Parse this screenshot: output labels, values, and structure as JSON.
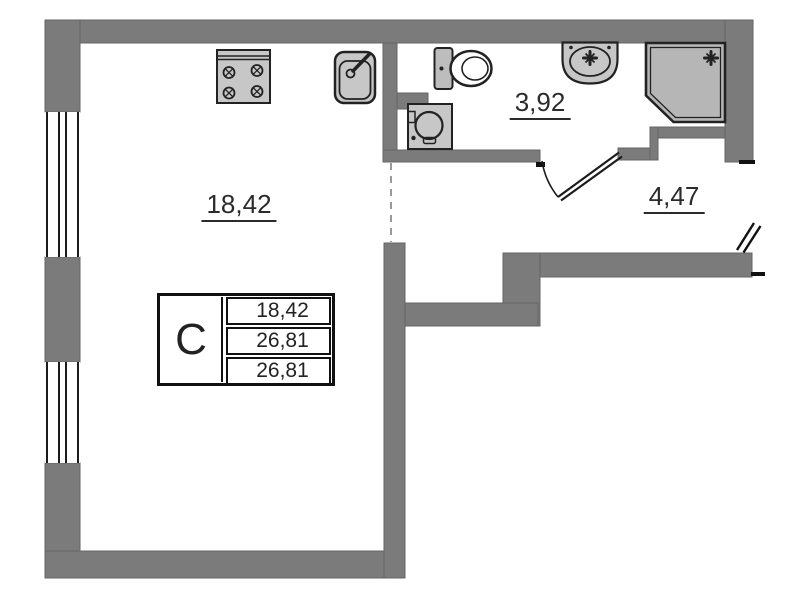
{
  "plan": {
    "title": "studio-apartment-floor-plan",
    "rooms": [
      {
        "name": "living-room",
        "area": "18,42"
      },
      {
        "name": "bathroom",
        "area": "3,92"
      },
      {
        "name": "hallway",
        "area": "4,47"
      }
    ],
    "legend_table": {
      "unit_type": "С",
      "rows": [
        "18,42",
        "26,81",
        "26,81"
      ]
    },
    "fixtures": [
      "stove-icon",
      "kitchen-sink-icon",
      "toilet-icon",
      "washbasin-icon",
      "shower-cabin-icon",
      "washing-machine-icon",
      "bathroom-door-swing-icon",
      "entry-door-icon",
      "window-icon"
    ],
    "theme": {
      "wall": "#7b7b7b",
      "wall_edge": "#666666",
      "outline": "#222222",
      "fixture": "#c7c7c7",
      "shower": "#b6b6b6",
      "dash": "#9a9a9a",
      "text": "#2b2b2b",
      "bg": "#ffffff"
    }
  }
}
